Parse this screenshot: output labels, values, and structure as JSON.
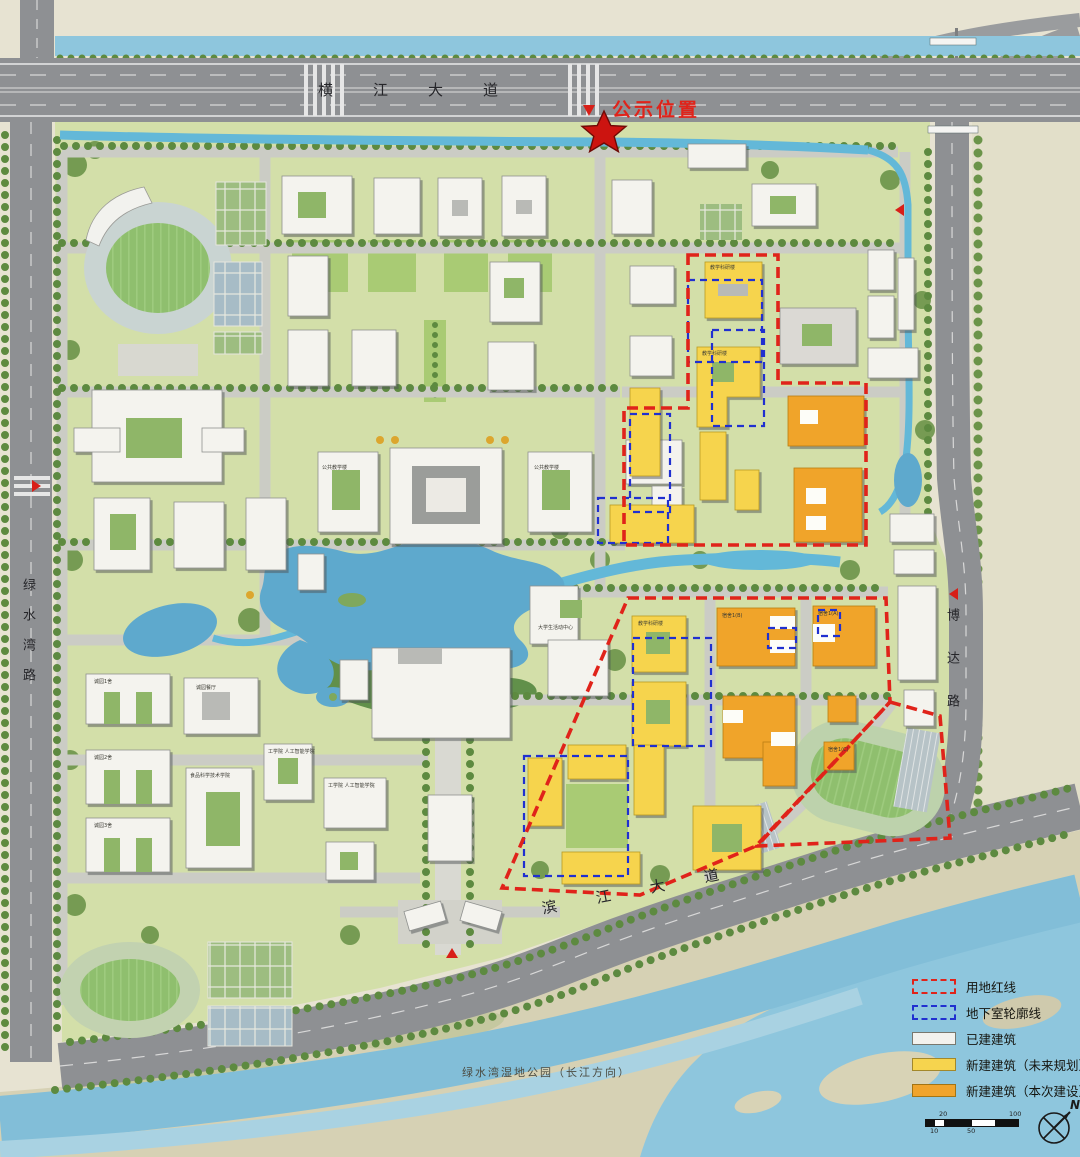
{
  "notice": {
    "label": "公示位置"
  },
  "roads": {
    "north": "横江大道",
    "west": "绿水湾路",
    "east": "博达路",
    "south": "滨江大道"
  },
  "park": {
    "label": "绿水湾湿地公园（长江方向）"
  },
  "labels": {
    "public_teaching_a": "公共教学楼",
    "public_teaching_b": "公共教学楼",
    "student_center": "大学生活动中心",
    "canteen": "诚园餐厅",
    "dorm_cy1": "诚园1舍",
    "dorm_cy2": "诚园2舍",
    "dorm_cy3": "诚园3舍",
    "food_college": "食品科学技术学院",
    "eng_ai_a": "工学院 人工智能学院",
    "eng_ai_b": "工学院 人工智能学院",
    "research_a": "教学科研楼",
    "research_b": "教学科研楼",
    "research_c": "教学科研楼",
    "dorm_1a": "宿舍1(A)",
    "dorm_1b": "宿舍1(B)",
    "dorm_1c": "宿舍1(C)"
  },
  "legend": {
    "items": [
      {
        "label": "用地红线",
        "type": "red-dash"
      },
      {
        "label": "地下室轮廓线",
        "type": "blue-dash"
      },
      {
        "label": "已建建筑",
        "type": "existing"
      },
      {
        "label": "新建建筑（未来规划）",
        "type": "future"
      },
      {
        "label": "新建建筑（本次建设）",
        "type": "current"
      }
    ]
  },
  "scalebar": {
    "ticks": [
      "10",
      "20",
      "50",
      "100"
    ]
  },
  "compass": {
    "label": "N"
  },
  "colors": {
    "land_red_line": "#e0231a",
    "basement_blue_line": "#2030d0",
    "existing_building": "#f2f2ee",
    "future_building": "#f6d44e",
    "current_building": "#f0a42c",
    "water": "#5ea9cd",
    "campus_green": "#d3dfa9"
  }
}
